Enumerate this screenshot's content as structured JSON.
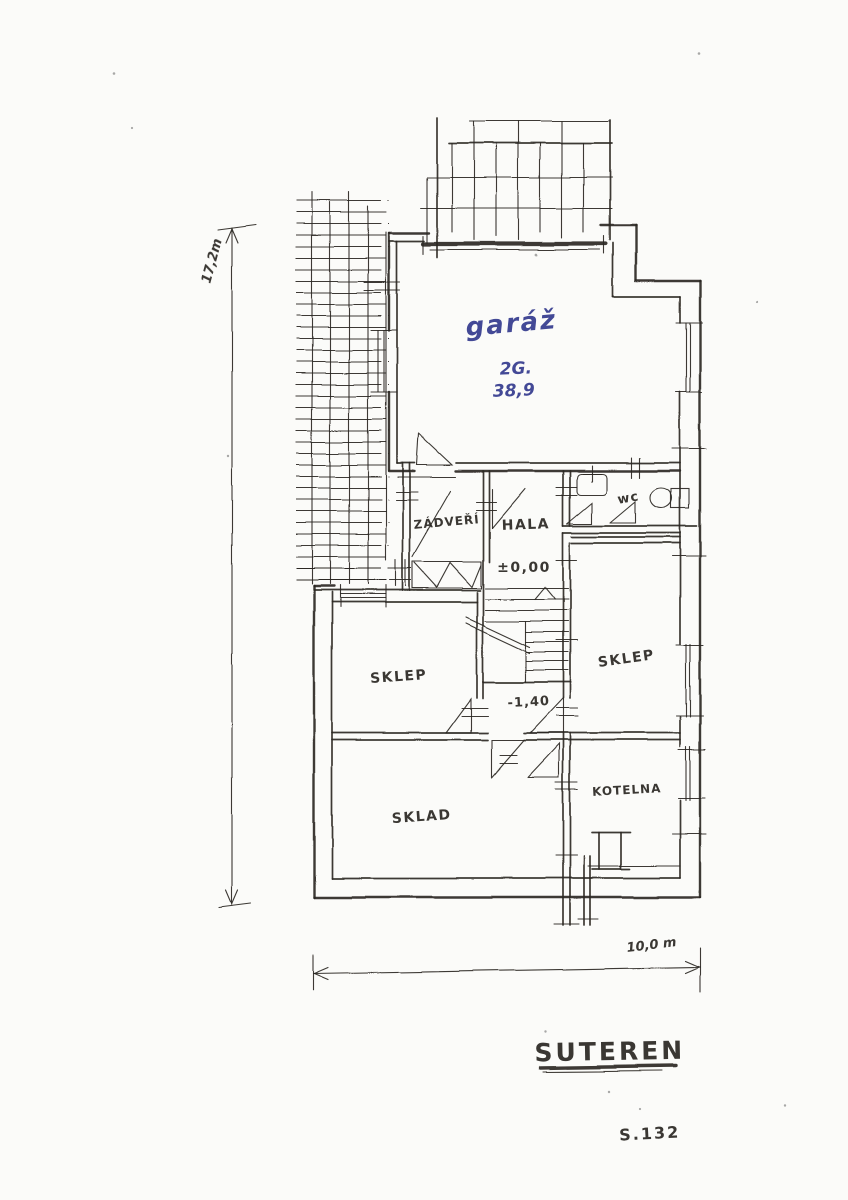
{
  "drawing": {
    "title": "SUTEREN",
    "sheet_code": "S.132"
  },
  "rooms": {
    "garage": {
      "name": "garáž",
      "code": "2G.",
      "area": "38,9"
    },
    "vestibule": {
      "name": "ZÁDVEŘÍ"
    },
    "hall": {
      "name": "HALA"
    },
    "wc": {
      "name": "wc"
    },
    "cellar_left": {
      "name": "SKLEP"
    },
    "cellar_right": {
      "name": "SKLEP"
    },
    "storage": {
      "name": "SKLAD"
    },
    "boiler_room": {
      "name": "KOTELNA"
    }
  },
  "levels": {
    "entry": "±0,00",
    "basement": "-1,40"
  },
  "dimensions": {
    "vertical": "17,2m",
    "horizontal": "10,0 m"
  },
  "symbols": {
    "sink": "washbasin-icon",
    "toilet": "toilet-icon",
    "boiler": "boiler-icon",
    "stairs": "staircase-symbol",
    "ramp": "hatched-ramp-symbol"
  },
  "colors": {
    "ink": "#2a2722",
    "blue_ink": "#333a8e",
    "paper": "#fbfbf9"
  }
}
